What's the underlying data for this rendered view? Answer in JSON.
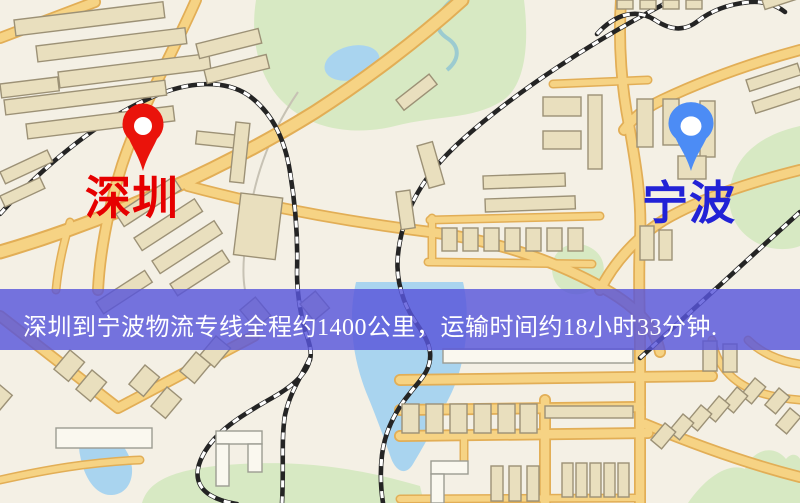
{
  "banner": {
    "text": "深圳到宁波物流专线全程约1400公里，运输时间约18小时33分钟.",
    "background_color": "#5856db",
    "text_color": "#ffffff",
    "distance_km": "1400",
    "duration": "18小时33分钟"
  },
  "map": {
    "origin": {
      "name": "深圳",
      "label_color": "#e60000",
      "pin_color": "#ea130b"
    },
    "destination": {
      "name": "宁波",
      "label_color": "#2222d6",
      "pin_color": "#4c8cf5"
    },
    "palette": {
      "background": "#f4f0e5",
      "road": "#f6d384",
      "road_casing": "#e2ae56",
      "park": "#d7e9c3",
      "water": "#a9d4ef",
      "building": "#e9dfbe",
      "railway": "#242424"
    }
  }
}
